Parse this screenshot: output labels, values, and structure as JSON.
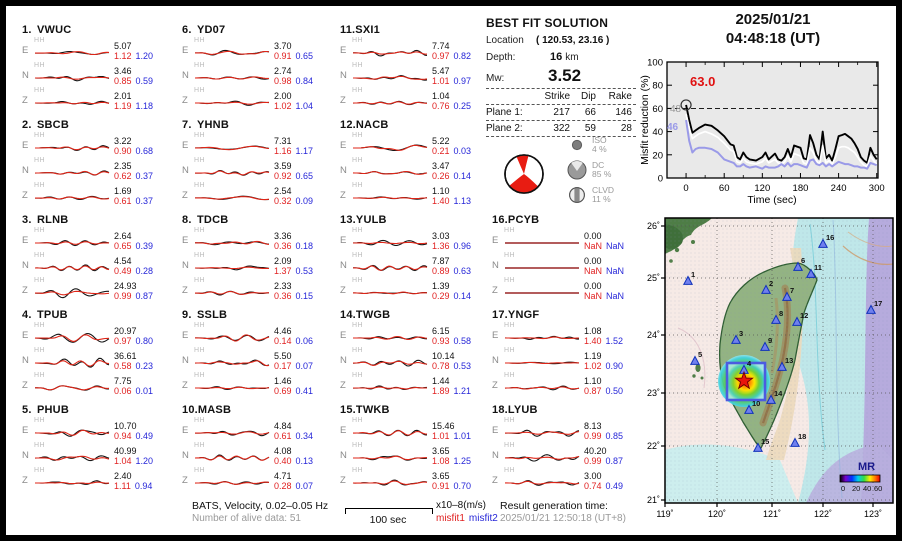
{
  "header": {
    "date": "2025/01/21",
    "time": "04:48:18  (UT)"
  },
  "best_fit": {
    "title": "BEST FIT SOLUTION",
    "location_label": "Location",
    "location_value": "( 120.53,  23.16 )",
    "depth_label": "Depth:",
    "depth_value": "16",
    "depth_unit": "km",
    "mw_label": "Mw:",
    "mw_value": "3.52",
    "table_headers": [
      "Strike",
      "Dip",
      "Rake"
    ],
    "planes": [
      {
        "label": "Plane 1:",
        "strike": "217",
        "dip": "66",
        "rake": "146"
      },
      {
        "label": "Plane 2:",
        "strike": "322",
        "dip": "59",
        "rake": "28"
      }
    ],
    "decomposition": [
      {
        "name": "ISO",
        "pct": "4 %"
      },
      {
        "name": "DC",
        "pct": "85 %"
      },
      {
        "name": "CLVD",
        "pct": "11 %"
      }
    ]
  },
  "misfit_plot": {
    "ylabel": "Misfit reduction (%)",
    "xlabel": "Time (sec)",
    "peak_label": "63.0",
    "label_gray": "48",
    "label_blue": "46",
    "yticks": [
      "0",
      "20",
      "40",
      "60",
      "80",
      "100"
    ],
    "xticks": [
      "0",
      "60",
      "120",
      "180",
      "240",
      "300"
    ],
    "dashed_y": 60
  },
  "stations": [
    {
      "num": "1.",
      "code": "VWUC",
      "comps": [
        [
          "E",
          "HH",
          "5.07",
          "1.12",
          "1.20"
        ],
        [
          "N",
          "HH",
          "3.46",
          "0.85",
          "0.59"
        ],
        [
          "Z",
          "HH",
          "2.01",
          "1.19",
          "1.18"
        ]
      ]
    },
    {
      "num": "2.",
      "code": "SBCB",
      "comps": [
        [
          "E",
          "HH",
          "3.22",
          "0.90",
          "0.68"
        ],
        [
          "N",
          "HH",
          "2.35",
          "0.62",
          "0.37"
        ],
        [
          "Z",
          "HH",
          "1.69",
          "0.61",
          "0.37"
        ]
      ]
    },
    {
      "num": "3.",
      "code": "RLNB",
      "comps": [
        [
          "E",
          "HH",
          "2.64",
          "0.65",
          "0.39"
        ],
        [
          "N",
          "HH",
          "4.54",
          "0.49",
          "0.28"
        ],
        [
          "Z",
          "HH",
          "24.93",
          "0.99",
          "0.87"
        ]
      ]
    },
    {
      "num": "4.",
      "code": "TPUB",
      "comps": [
        [
          "E",
          "HH",
          "20.97",
          "0.97",
          "0.80"
        ],
        [
          "N",
          "HH",
          "36.61",
          "0.58",
          "0.23"
        ],
        [
          "Z",
          "HH",
          "7.75",
          "0.06",
          "0.01"
        ]
      ]
    },
    {
      "num": "5.",
      "code": "PHUB",
      "comps": [
        [
          "E",
          "HH",
          "10.70",
          "0.94",
          "0.49"
        ],
        [
          "N",
          "HH",
          "40.99",
          "1.04",
          "1.20"
        ],
        [
          "Z",
          "HH",
          "2.40",
          "1.11",
          "0.94"
        ]
      ]
    },
    {
      "num": "6.",
      "code": "YD07",
      "comps": [
        [
          "E",
          "HH",
          "3.70",
          "0.91",
          "0.65"
        ],
        [
          "N",
          "HH",
          "2.74",
          "0.98",
          "0.84"
        ],
        [
          "Z",
          "HH",
          "2.00",
          "1.02",
          "1.04"
        ]
      ]
    },
    {
      "num": "7.",
      "code": "YHNB",
      "comps": [
        [
          "E",
          "HH",
          "7.31",
          "1.16",
          "1.17"
        ],
        [
          "N",
          "HH",
          "3.59",
          "0.92",
          "0.65"
        ],
        [
          "Z",
          "HH",
          "2.54",
          "0.32",
          "0.09"
        ]
      ]
    },
    {
      "num": "8.",
      "code": "TDCB",
      "comps": [
        [
          "E",
          "HH",
          "3.36",
          "0.36",
          "0.18"
        ],
        [
          "N",
          "HH",
          "2.09",
          "1.37",
          "0.53"
        ],
        [
          "Z",
          "HH",
          "2.33",
          "0.36",
          "0.15"
        ]
      ]
    },
    {
      "num": "9.",
      "code": "SSLB",
      "comps": [
        [
          "E",
          "HH",
          "4.46",
          "0.14",
          "0.06"
        ],
        [
          "N",
          "HH",
          "5.50",
          "0.17",
          "0.07"
        ],
        [
          "Z",
          "HH",
          "1.46",
          "0.69",
          "0.41"
        ]
      ]
    },
    {
      "num": "10.",
      "code": "MASB",
      "comps": [
        [
          "E",
          "HH",
          "4.84",
          "0.61",
          "0.34"
        ],
        [
          "N",
          "HH",
          "4.08",
          "0.40",
          "0.13"
        ],
        [
          "Z",
          "HH",
          "4.71",
          "0.28",
          "0.07"
        ]
      ]
    },
    {
      "num": "11.",
      "code": "SXI1",
      "comps": [
        [
          "E",
          "HH",
          "7.74",
          "0.97",
          "0.82"
        ],
        [
          "N",
          "HH",
          "5.47",
          "1.01",
          "0.97"
        ],
        [
          "Z",
          "HH",
          "1.04",
          "0.76",
          "0.25"
        ]
      ]
    },
    {
      "num": "12.",
      "code": "NACB",
      "comps": [
        [
          "E",
          "HH",
          "5.22",
          "0.21",
          "0.03"
        ],
        [
          "N",
          "HH",
          "3.47",
          "0.26",
          "0.14"
        ],
        [
          "Z",
          "HH",
          "1.10",
          "1.40",
          "1.13"
        ]
      ]
    },
    {
      "num": "13.",
      "code": "YULB",
      "comps": [
        [
          "E",
          "HH",
          "3.03",
          "1.36",
          "0.96"
        ],
        [
          "N",
          "HH",
          "7.87",
          "0.89",
          "0.63"
        ],
        [
          "Z",
          "HH",
          "1.39",
          "0.29",
          "0.14"
        ]
      ]
    },
    {
      "num": "14.",
      "code": "TWGB",
      "comps": [
        [
          "E",
          "HH",
          "6.15",
          "0.93",
          "0.58"
        ],
        [
          "N",
          "HH",
          "10.14",
          "0.78",
          "0.53"
        ],
        [
          "Z",
          "HH",
          "1.44",
          "1.89",
          "1.21"
        ]
      ]
    },
    {
      "num": "15.",
      "code": "TWKB",
      "comps": [
        [
          "E",
          "HH",
          "15.46",
          "1.01",
          "1.01"
        ],
        [
          "N",
          "HH",
          "3.65",
          "1.08",
          "1.25"
        ],
        [
          "Z",
          "HH",
          "3.65",
          "0.91",
          "0.70"
        ]
      ]
    },
    {
      "num": "16.",
      "code": "PCYB",
      "comps": [
        [
          "E",
          "HH",
          "0.00",
          "NaN",
          "NaN"
        ],
        [
          "N",
          "HH",
          "0.00",
          "NaN",
          "NaN"
        ],
        [
          "Z",
          "HH",
          "0.00",
          "NaN",
          "NaN"
        ]
      ]
    },
    {
      "num": "17.",
      "code": "YNGF",
      "comps": [
        [
          "E",
          "HH",
          "1.08",
          "1.40",
          "1.52"
        ],
        [
          "N",
          "HH",
          "1.19",
          "1.02",
          "0.90"
        ],
        [
          "Z",
          "HH",
          "1.10",
          "0.87",
          "0.50"
        ]
      ]
    },
    {
      "num": "18.",
      "code": "LYUB",
      "comps": [
        [
          "E",
          "HH",
          "8.13",
          "0.99",
          "0.85"
        ],
        [
          "N",
          "HH",
          "40.20",
          "0.99",
          "0.87"
        ],
        [
          "Z",
          "HH",
          "3.00",
          "0.74",
          "0.49"
        ]
      ]
    }
  ],
  "map": {
    "lat_labels": [
      {
        "t": "26˚",
        "y": 8
      },
      {
        "t": "25˚",
        "y": 60
      },
      {
        "t": "24˚",
        "y": 117
      },
      {
        "t": "23˚",
        "y": 175
      },
      {
        "t": "22˚",
        "y": 228
      },
      {
        "t": "21˚",
        "y": 282
      }
    ],
    "lon_labels": [
      {
        "t": "119˚",
        "x": 0
      },
      {
        "t": "120˚",
        "x": 52
      },
      {
        "t": "121˚",
        "x": 107
      },
      {
        "t": "122˚",
        "x": 158
      },
      {
        "t": "123˚",
        "x": 208
      }
    ],
    "stations": [
      {
        "n": "1",
        "x": 23,
        "y": 63
      },
      {
        "n": "2",
        "x": 101,
        "y": 72
      },
      {
        "n": "3",
        "x": 71,
        "y": 122
      },
      {
        "n": "4",
        "x": 79,
        "y": 152
      },
      {
        "n": "5",
        "x": 30,
        "y": 143
      },
      {
        "n": "6",
        "x": 133,
        "y": 49
      },
      {
        "n": "7",
        "x": 122,
        "y": 79
      },
      {
        "n": "8",
        "x": 111,
        "y": 102
      },
      {
        "n": "9",
        "x": 100,
        "y": 129
      },
      {
        "n": "10",
        "x": 84,
        "y": 192
      },
      {
        "n": "11",
        "x": 146,
        "y": 56
      },
      {
        "n": "12",
        "x": 132,
        "y": 104
      },
      {
        "n": "13",
        "x": 117,
        "y": 149
      },
      {
        "n": "14",
        "x": 106,
        "y": 182
      },
      {
        "n": "15",
        "x": 93,
        "y": 230
      },
      {
        "n": "16",
        "x": 158,
        "y": 26
      },
      {
        "n": "17",
        "x": 206,
        "y": 92
      },
      {
        "n": "18",
        "x": 130,
        "y": 225
      }
    ],
    "star": {
      "x": 79,
      "y": 163
    },
    "search_box": {
      "x": 62,
      "y": 145,
      "w": 38,
      "h": 37
    },
    "colorbar": {
      "title": "MR",
      "ticks": [
        "0",
        "20",
        "40",
        "60"
      ]
    }
  },
  "footer": {
    "filter": "BATS, Velocity, 0.02–0.05 Hz",
    "alive": "Number of alive data: 51",
    "scale": "100 sec",
    "unit": "x10–8(m/s)",
    "misfit1": "misfit1",
    "misfit2": "misfit2",
    "result_label": "Result generation time:",
    "result_value": "2025/01/21 12:50:18 (UT+8)"
  },
  "colors": {
    "misfit1_red": "#e02020",
    "misfit2_blue": "#2626d8",
    "curve_blue": "#9a9ae8",
    "beachball_red": "#e81c12",
    "station_triangle": "#6f7fee",
    "plot_bg": "#e9e9e9"
  },
  "chart_data": [
    {
      "type": "line",
      "title": "Misfit reduction vs time",
      "xlabel": "Time (sec)",
      "ylabel": "Misfit reduction (%)",
      "xlim": [
        -30,
        302
      ],
      "ylim": [
        0,
        100
      ],
      "grid": false,
      "annotations": {
        "best_value": 63.0,
        "gray_value": 48,
        "blue_value": 46,
        "dashed_line_y": 60
      },
      "x": [
        0,
        5,
        10,
        15,
        20,
        30,
        40,
        50,
        60,
        70,
        75,
        80,
        85,
        90,
        95,
        100,
        110,
        120,
        125,
        130,
        140,
        145,
        150,
        155,
        160,
        165,
        170,
        175,
        180,
        185,
        190,
        195,
        200,
        205,
        210,
        215,
        220,
        225,
        230,
        235,
        240,
        245,
        250,
        255,
        260,
        265,
        270,
        275,
        280,
        285,
        290,
        295,
        300
      ],
      "series": [
        {
          "name": "misfit-black",
          "color": "#000000",
          "y": [
            63,
            50,
            39,
            41,
            43,
            46,
            45,
            41,
            36,
            29,
            28,
            18,
            16,
            22,
            18,
            16,
            15,
            18,
            22,
            16,
            21,
            16,
            15,
            18,
            25,
            18,
            28,
            27,
            26,
            17,
            16,
            37,
            30,
            20,
            16,
            40,
            17,
            20,
            15,
            25,
            36,
            37,
            38,
            36,
            34,
            30,
            25,
            18,
            15,
            13,
            26,
            20,
            16
          ]
        },
        {
          "name": "misfit-white",
          "color": "#ffffff",
          "y": [
            55,
            43,
            34,
            36,
            38,
            40,
            38,
            35,
            30,
            24,
            23,
            14,
            13,
            17,
            14,
            13,
            12,
            14,
            17,
            13,
            16,
            13,
            12,
            14,
            19,
            14,
            21,
            20,
            19,
            13,
            12,
            26,
            22,
            15,
            12,
            28,
            13,
            15,
            12,
            18,
            26,
            27,
            27,
            26,
            24,
            22,
            18,
            14,
            11,
            10,
            19,
            15,
            12
          ]
        },
        {
          "name": "misfit-blue",
          "color": "#9a9ae8",
          "y": [
            50,
            32,
            22,
            25,
            26,
            26,
            25,
            22,
            16,
            14,
            13,
            10,
            10,
            12,
            10,
            9,
            10,
            8,
            10,
            9,
            9,
            10,
            12,
            10,
            13,
            10,
            12,
            12,
            11,
            10,
            9,
            15,
            16,
            12,
            11,
            13,
            10,
            12,
            10,
            12,
            14,
            13,
            12,
            12,
            11,
            10,
            10,
            9,
            9,
            8,
            13,
            12,
            11
          ]
        }
      ]
    },
    {
      "type": "table",
      "title": "Station waveform peak amplitudes (x10–8 m/s) and misfits",
      "columns": [
        "station",
        "component",
        "amplitude",
        "misfit1",
        "misfit2"
      ],
      "note": "Full values are in stations[] of this JSON block"
    }
  ]
}
